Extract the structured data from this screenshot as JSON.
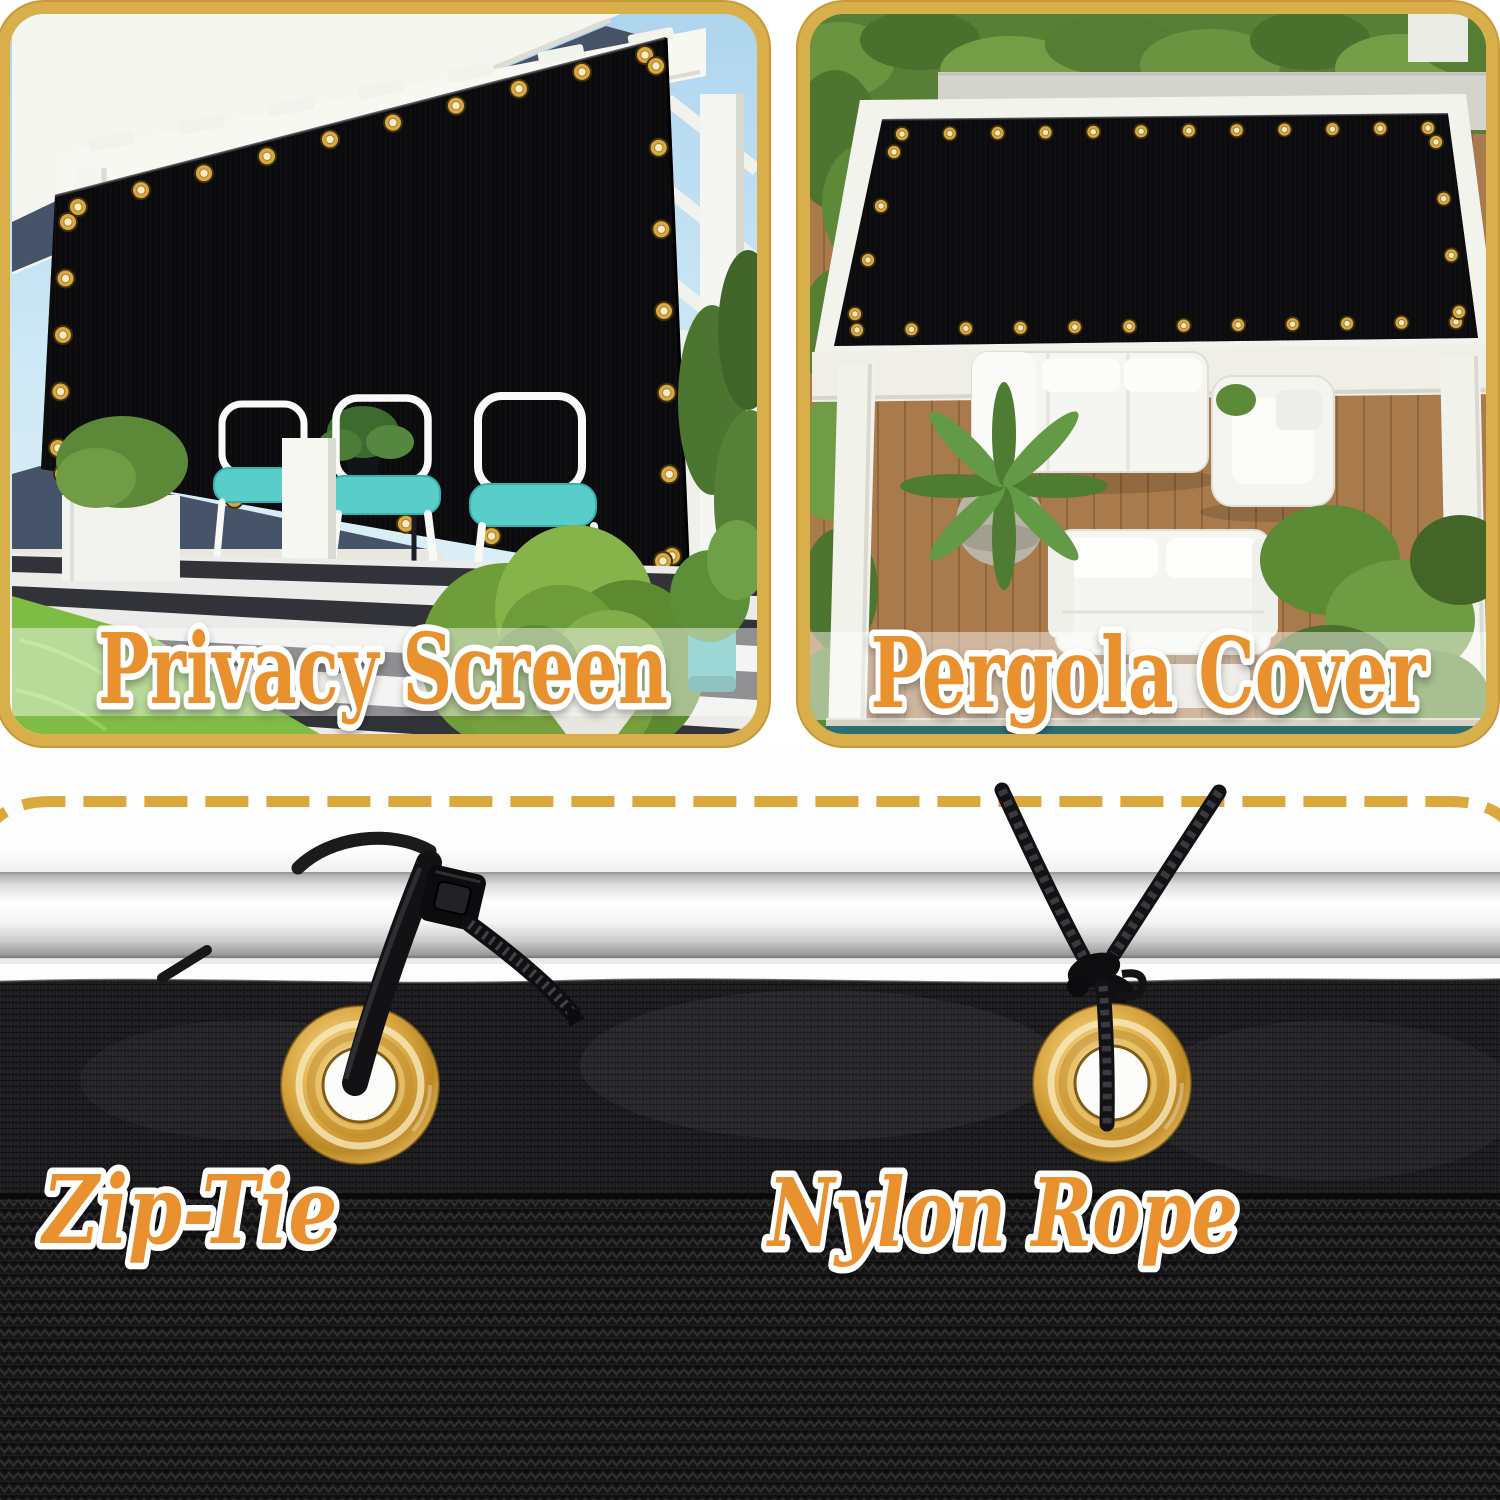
{
  "image_type": "product-feature-graphic",
  "top_panels": [
    {
      "id": "privacy-screen",
      "label": "Privacy Screen"
    },
    {
      "id": "pergola-cover",
      "label": "Pergola Cover"
    }
  ],
  "bottom_annotations": [
    {
      "id": "zip-tie",
      "label": "Zip-Tie"
    },
    {
      "id": "nylon-rope",
      "label": "Nylon Rope"
    }
  ],
  "colors": {
    "label_orange": "#E8912D",
    "label_outline": "#FFFFFF",
    "panel_border_gold": "#D9AF4B",
    "dashed_line_gold": "#DBA83E",
    "grommet_brass": "#D6A33F",
    "mesh_black": "#18181A",
    "screen_fabric_black": "#0B0B0D",
    "pole_silver": "#EDEDED",
    "cushion_teal": "#58CDCA",
    "wall_navy": "#475369",
    "grass_green": "#7FBC43",
    "deck_wood": "#A87A4C"
  }
}
